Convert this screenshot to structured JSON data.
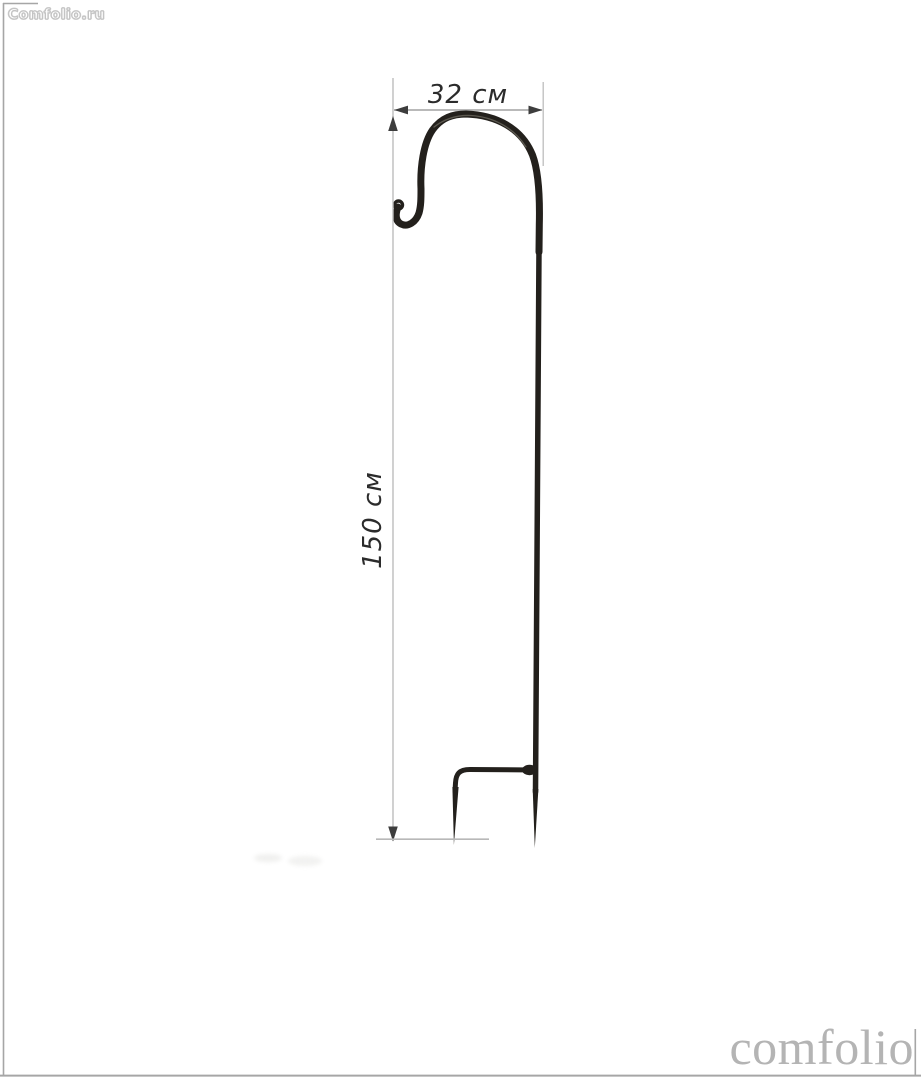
{
  "page": {
    "background": "#ffffff"
  },
  "watermarks": {
    "top_left": "Comfolio.ru",
    "bottom_right": "comfolio"
  },
  "dimensions": {
    "width_label": "32 см",
    "height_label": "150 см"
  },
  "colors": {
    "product": "#23201c",
    "product_highlight": "#7a766c",
    "dim_text": "#2b2b2b",
    "arrowhead": "#3d3d3d",
    "dim_line": "#8f8f8f",
    "ext_line": "#bdbdbd",
    "ground_line": "#b8b8b8",
    "frame": "#a6a6a6",
    "watermark_gray": "#b4b4b4",
    "shadow": "#ebebe9"
  }
}
